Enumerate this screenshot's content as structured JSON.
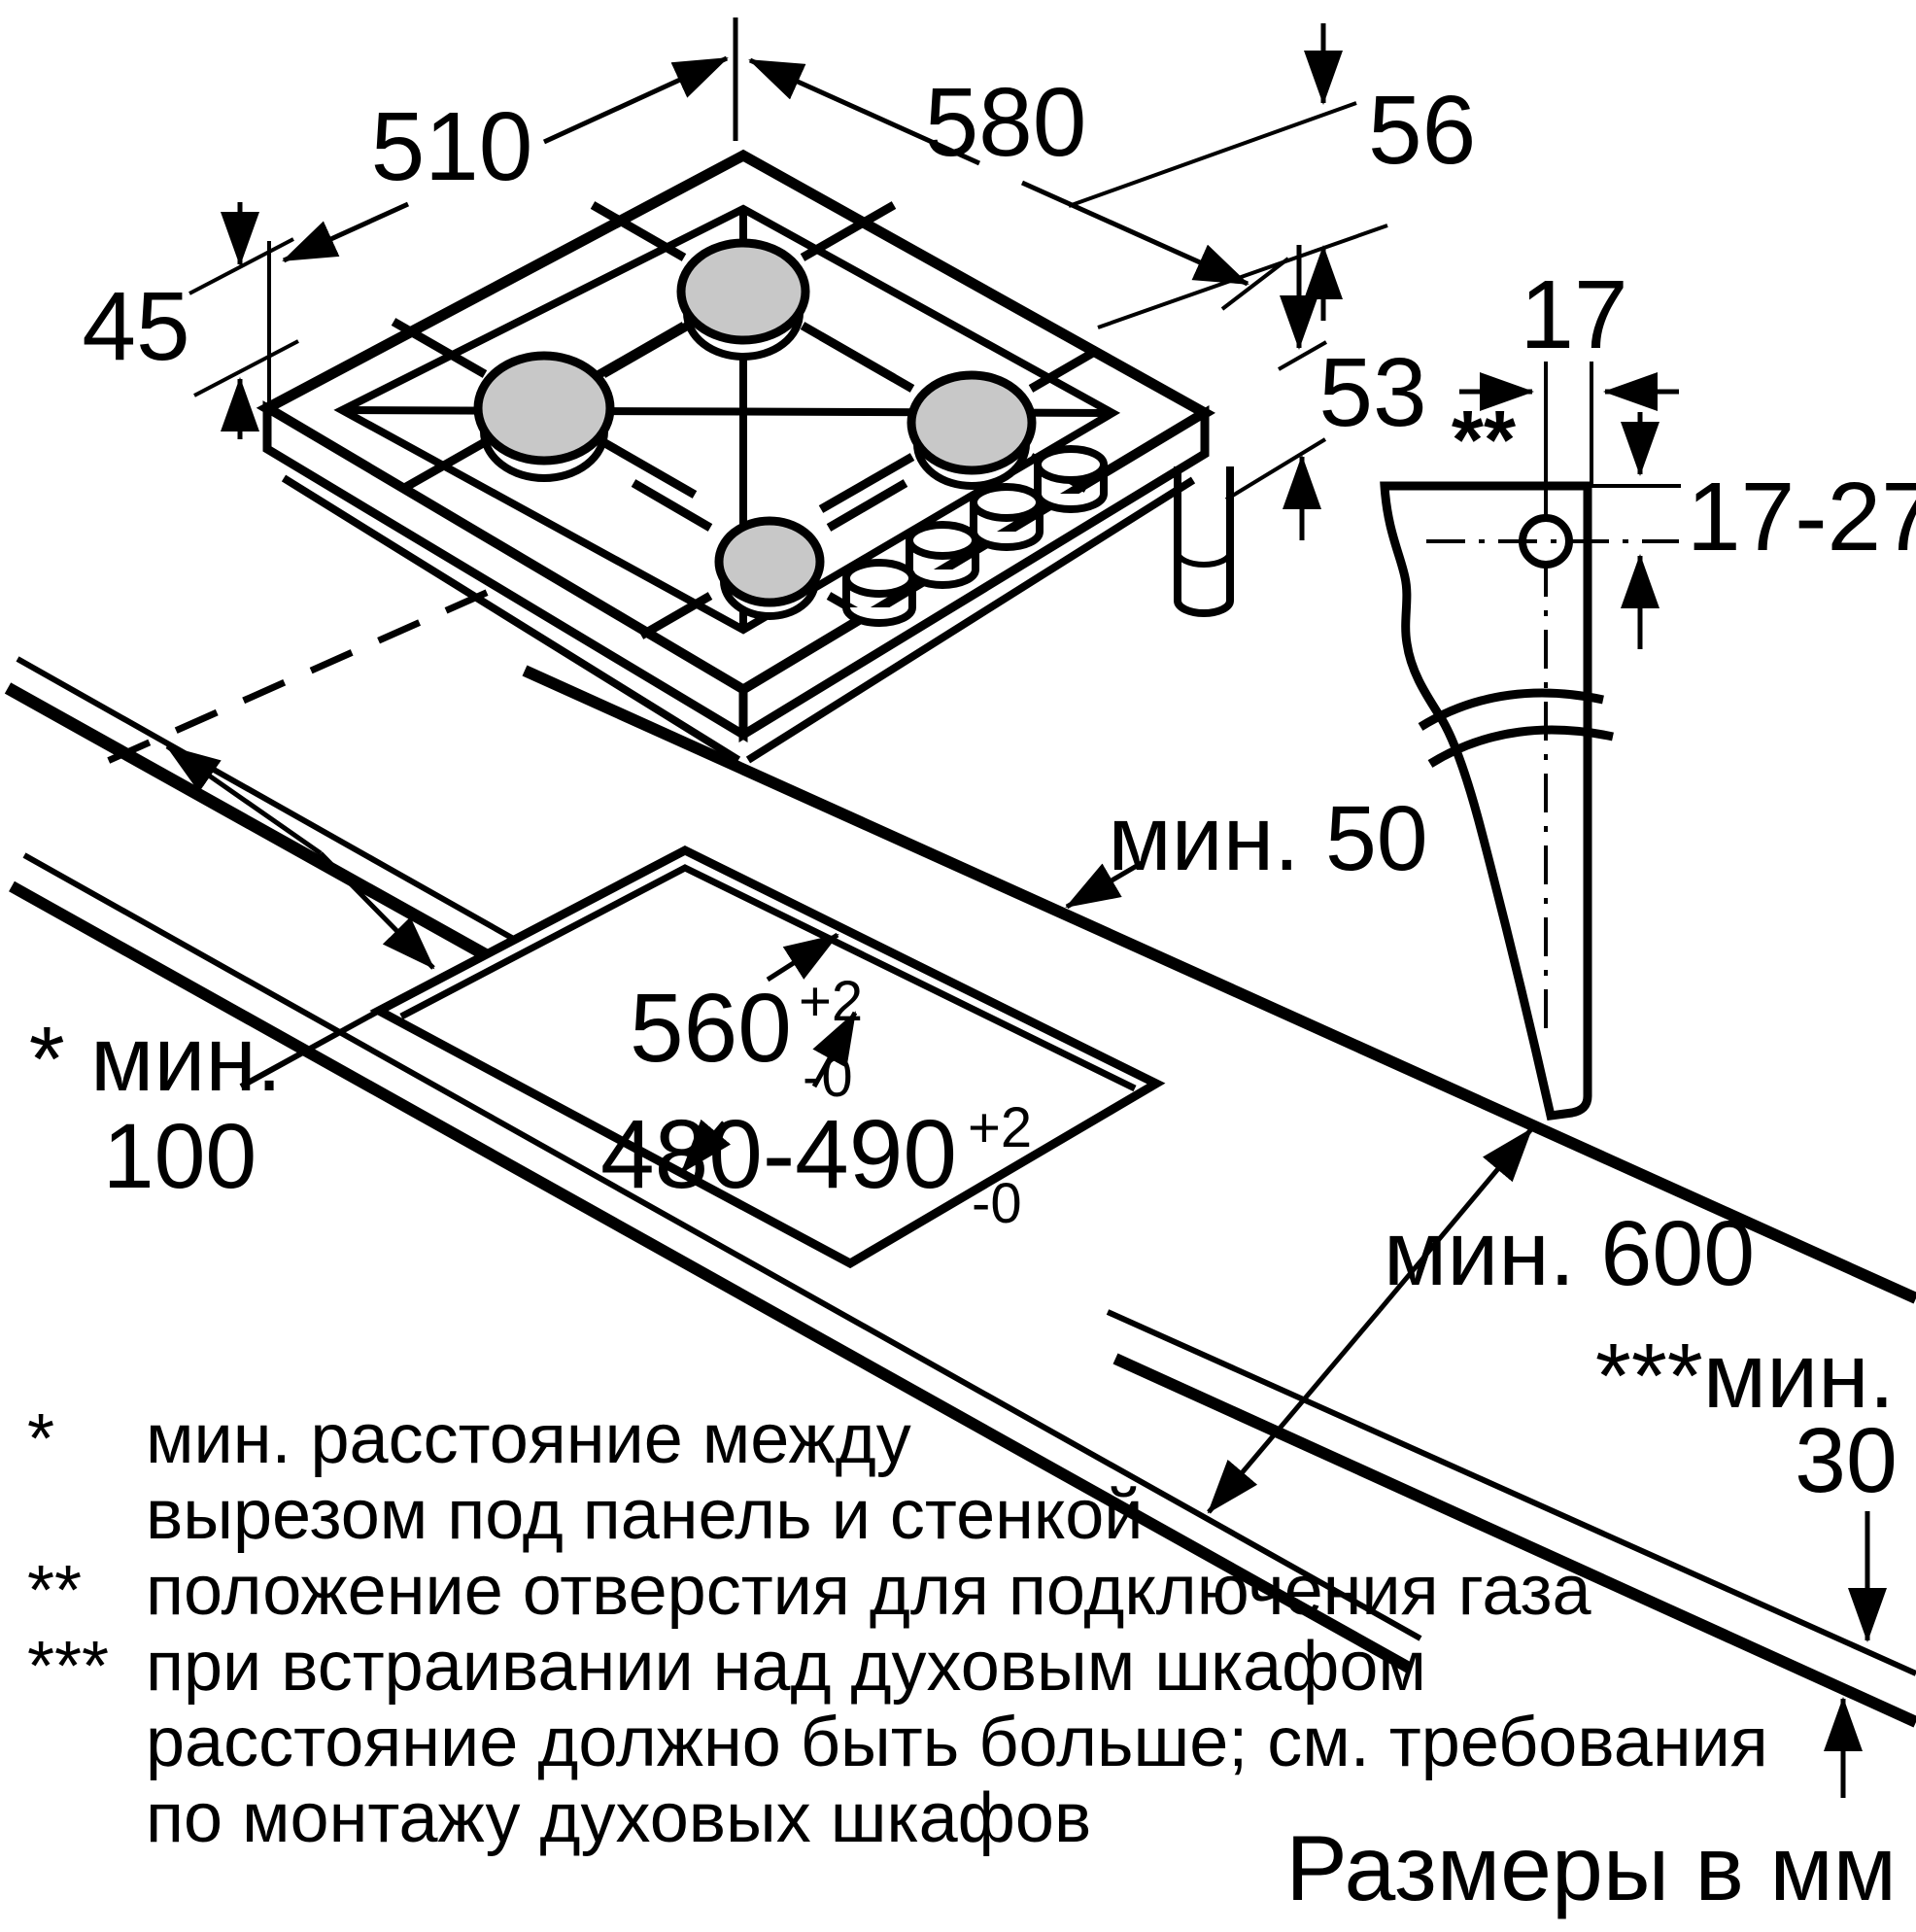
{
  "units_note": "Размеры в мм",
  "dims": {
    "depth": "510",
    "width": "580",
    "height_right": "56",
    "height_front": "45",
    "box_height": "53",
    "gas_wall_thickness": "17",
    "gas_hole_offset": "17-27",
    "gas_hole_marker": "**",
    "cutout_width": "560",
    "cutout_depth": "480-490",
    "tol_plus": "+2",
    "tol_minus": "-0",
    "min_rear": "мин. 50",
    "min_side_label": "* мин.",
    "min_side_value": "100",
    "min_worktop_depth": "мин. 600",
    "min_oven_label": "***мин.",
    "min_oven_value": "30"
  },
  "footnotes": {
    "marker1": "*",
    "line1": "мин. расстояние между",
    "line2": "вырезом под панель и стенкой",
    "marker2": "**",
    "line3": "положение отверстия для подключения газа",
    "marker3": "***",
    "line4": "при встраивании над духовым шкафом",
    "line5": "расстояние должно быть больше; см. требования",
    "line6": "по монтажу духовых шкафов"
  }
}
